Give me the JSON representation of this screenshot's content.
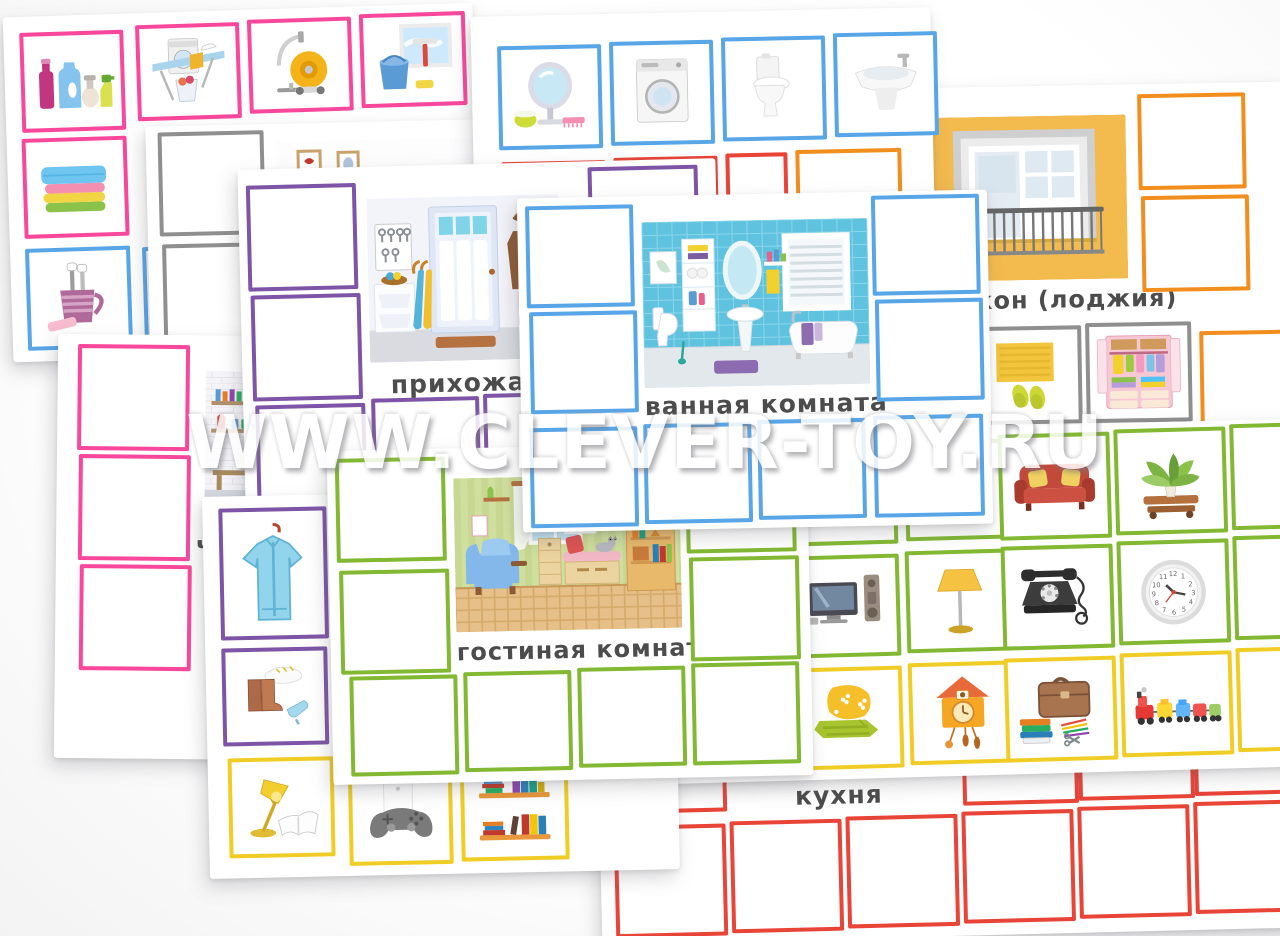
{
  "watermark": "WWW.CLEVER-TOY.RU",
  "palette": {
    "pink": "#f9489c",
    "blue": "#58a6e8",
    "red": "#e94438",
    "orange": "#f28e1e",
    "purple": "#7e55a6",
    "green": "#82b832",
    "yellow": "#f0cd25",
    "gray": "#8f8f8f"
  },
  "clock_face": {
    "n12": "12",
    "n1": "1",
    "n2": "2",
    "n3": "3",
    "n4": "4",
    "n5": "5",
    "n6": "6",
    "n7": "7",
    "n8": "8",
    "n9": "9",
    "n10": "10",
    "n11": "11"
  },
  "cards": {
    "cleaning_items_sheet": {
      "visible_tiles": [
        "cleaning-bottles",
        "ironing-set",
        "vacuum-cleaner",
        "window-washing",
        "towels-stack",
        "toothbrush-cup"
      ]
    },
    "study_sheet": {
      "visible_tiles": [
        "picture-frames",
        "candles",
        "shelf-with-books"
      ]
    },
    "bath_items_sheet": {
      "visible_tiles": [
        "table-mirror",
        "washing-machine",
        "toilet",
        "bidet"
      ]
    },
    "balcony_card": {
      "title": "балкон (лоджия)",
      "visible_tiles": [
        "rug-and-slippers",
        "wardrobe"
      ]
    },
    "storage_card": {
      "title_visible": "ч"
    },
    "hallway_card": {
      "title": "прихожая"
    },
    "kitchen_card": {
      "title": "кухня"
    },
    "furniture_items_sheet": {
      "visible_tiles": [
        "tv-stand",
        "sofa",
        "houseplant",
        "tv-set",
        "floor-lamp",
        "telephone",
        "wall-clock",
        "cushion-and-blanket",
        "cuckoo-clock",
        "briefcase-and-books",
        "toy-train"
      ]
    },
    "clothes_items_sheet": {
      "visible_tiles": [
        "jacket",
        "boots-and-shoes",
        "desk-lamp",
        "game-controller",
        "bookshelf"
      ]
    },
    "living_room_card": {
      "title": "гостиная комната"
    },
    "bathroom_card": {
      "title": "ванная комната"
    }
  }
}
